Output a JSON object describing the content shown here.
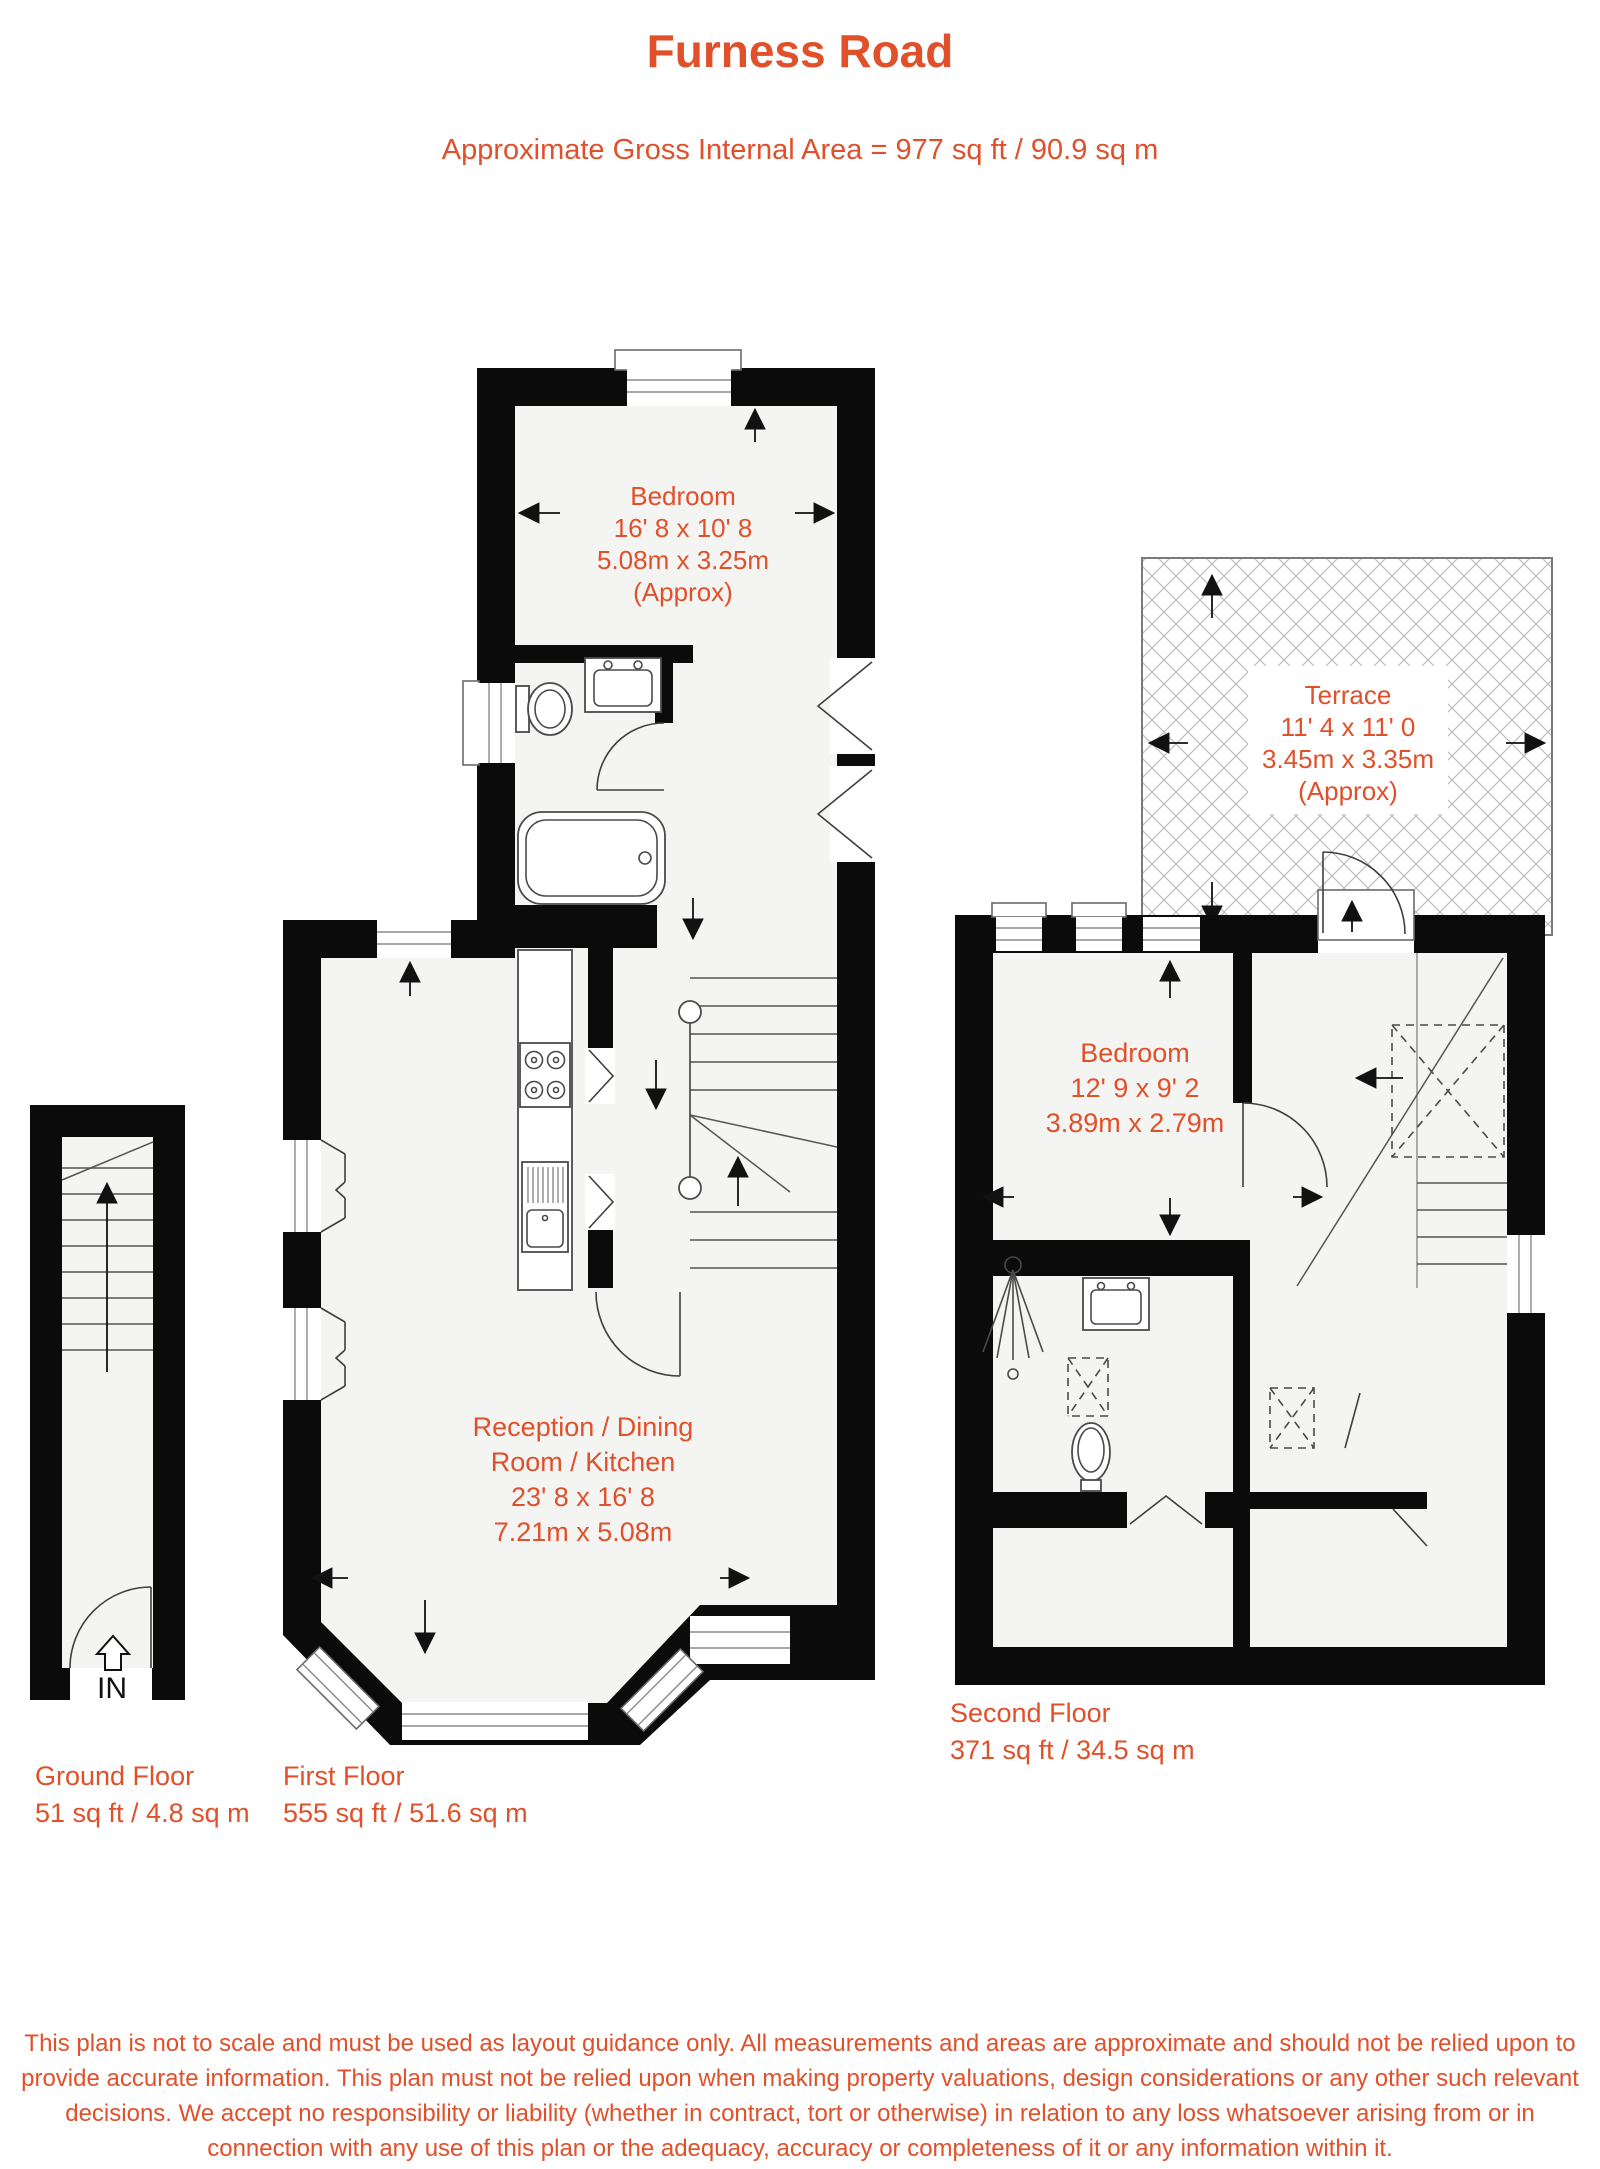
{
  "header": {
    "title": "Furness Road",
    "subtitle": "Approximate Gross Internal Area = 977 sq ft / 90.9 sq m"
  },
  "rooms": {
    "bedroom_first": {
      "name": "Bedroom",
      "size_imperial": "16' 8 x 10' 8",
      "size_metric": "5.08m x 3.25m",
      "approx": "(Approx)"
    },
    "terrace": {
      "name": "Terrace",
      "size_imperial": "11' 4 x 11' 0",
      "size_metric": "3.45m x 3.35m",
      "approx": "(Approx)"
    },
    "bedroom_second": {
      "name": "Bedroom",
      "size_imperial": "12' 9 x 9' 2",
      "size_metric": "3.89m x 2.79m"
    },
    "reception": {
      "name_line1": "Reception / Dining",
      "name_line2": "Room / Kitchen",
      "size_imperial": "23' 8 x 16' 8",
      "size_metric": "7.21m x 5.08m"
    }
  },
  "floors": {
    "ground": {
      "label": "Ground Floor",
      "area": "51 sq ft / 4.8 sq m"
    },
    "first": {
      "label": "First Floor",
      "area": "555 sq ft / 51.6 sq m"
    },
    "second": {
      "label": "Second Floor",
      "area": "371 sq ft / 34.5 sq m"
    }
  },
  "entrance": {
    "label": "IN"
  },
  "disclaimer": "This plan is not to scale and must be used as layout guidance only. All measurements and areas are approximate and should not be relied upon to provide accurate information. This plan must not be relied upon when making property valuations, design considerations or any other such relevant decisions. We accept no responsibility or liability (whether in contract, tort or otherwise) in relation to any loss whatsoever arising from or in connection with any use of this plan or the adequacy, accuracy or completeness of it or any information within it.",
  "colors": {
    "accent": "#e0502a",
    "wall": "#0b0b0b",
    "floor_fill": "#f4f4f2",
    "line": "#3f3f3f",
    "hatch": "#bdbdbd"
  }
}
